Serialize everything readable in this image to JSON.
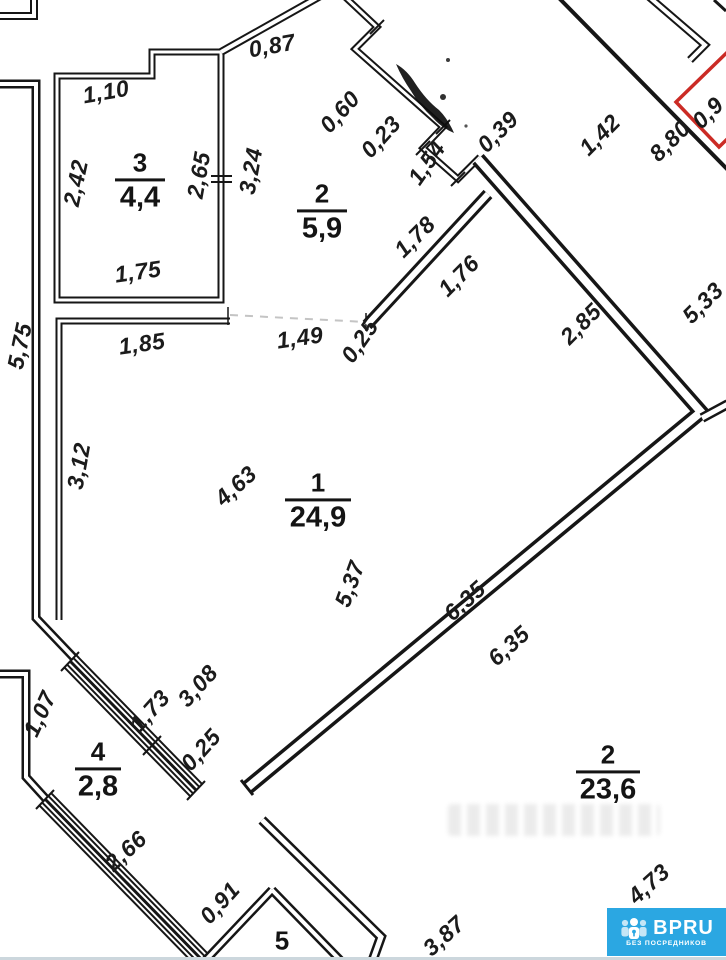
{
  "plan": {
    "type": "floor-plan",
    "units": "meters"
  },
  "rooms": [
    {
      "number": "3",
      "area": "4,4"
    },
    {
      "number": "2",
      "area": "5,9"
    },
    {
      "number": "1",
      "area": "24,9"
    },
    {
      "number": "4",
      "area": "2,8"
    },
    {
      "number": "2",
      "area": "23,6"
    },
    {
      "number": "5",
      "area": ""
    }
  ],
  "dimensions": [
    {
      "text": "0,87"
    },
    {
      "text": "1,10"
    },
    {
      "text": "2,42"
    },
    {
      "text": "2,65"
    },
    {
      "text": "3,24"
    },
    {
      "text": "0,60"
    },
    {
      "text": "0,23"
    },
    {
      "text": "1,54"
    },
    {
      "text": "0,39"
    },
    {
      "text": "1,42"
    },
    {
      "text": "8,80"
    },
    {
      "text": "1,78"
    },
    {
      "text": "1,76"
    },
    {
      "text": "2,85"
    },
    {
      "text": "5,33"
    },
    {
      "text": "1,75"
    },
    {
      "text": "1,85"
    },
    {
      "text": "5,75"
    },
    {
      "text": "3,12"
    },
    {
      "text": "1,49"
    },
    {
      "text": "0,25"
    },
    {
      "text": "4,63"
    },
    {
      "text": "5,37"
    },
    {
      "text": "6,35"
    },
    {
      "text": "6,35"
    },
    {
      "text": "3,08"
    },
    {
      "text": "1,73"
    },
    {
      "text": "0,25"
    },
    {
      "text": "1,07"
    },
    {
      "text": "2,66"
    },
    {
      "text": "0,91"
    },
    {
      "text": "3,87"
    },
    {
      "text": "4,73"
    },
    {
      "text": "0,9"
    }
  ],
  "annotations": {
    "red_zone_color": "#cb2b25",
    "wall_color": "#161616",
    "dashed_color": "#c4c4c4"
  },
  "logo": {
    "brand": "BPRU",
    "tagline": "БЕЗ ПОСРЕДНИКОВ",
    "blue": "#2ba7e2"
  }
}
